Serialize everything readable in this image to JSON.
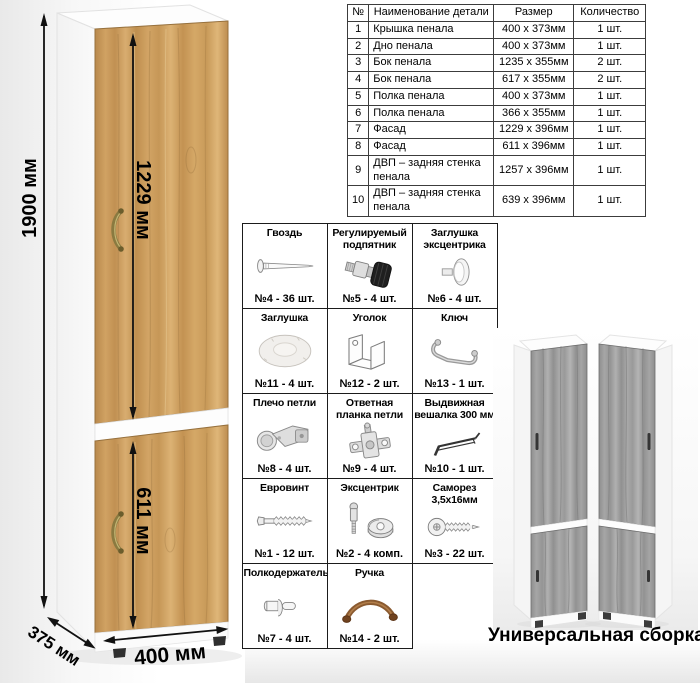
{
  "diagram": {
    "dimensions": {
      "height": "1900 мм",
      "upper_door": "1229 мм",
      "lower_door": "611 мм",
      "depth": "375 мм",
      "width": "400 мм"
    },
    "colors": {
      "wood": "#c89a5c",
      "wood_grain_dark": "#8f6a38",
      "gray_wood": "#9e9e9e",
      "carcass_white": "#fbfbfb",
      "handle_brass": "#8a7a40",
      "dimension_line": "#111111"
    }
  },
  "parts_table": {
    "headers": [
      "№",
      "Наименование детали",
      "Размер",
      "Количество"
    ],
    "rows": [
      {
        "num": "1",
        "name": "Крышка пенала",
        "size": "400 х 373мм",
        "qty": "1 шт."
      },
      {
        "num": "2",
        "name": "Дно пенала",
        "size": "400 х 373мм",
        "qty": "1 шт."
      },
      {
        "num": "3",
        "name": "Бок пенала",
        "size": "1235 х 355мм",
        "qty": "2 шт."
      },
      {
        "num": "4",
        "name": "Бок пенала",
        "size": "617 х 355мм",
        "qty": "2 шт."
      },
      {
        "num": "5",
        "name": "Полка пенала",
        "size": "400 х 373мм",
        "qty": "1 шт."
      },
      {
        "num": "6",
        "name": "Полка пенала",
        "size": "366 х 355мм",
        "qty": "1 шт."
      },
      {
        "num": "7",
        "name": "Фасад",
        "size": "1229 х 396мм",
        "qty": "1 шт."
      },
      {
        "num": "8",
        "name": "Фасад",
        "size": "611 х 396мм",
        "qty": "1 шт."
      },
      {
        "num": "9",
        "name": "ДВП – задняя стенка пенала",
        "size": "1257 х 396мм",
        "qty": "1 шт."
      },
      {
        "num": "10",
        "name": "ДВП – задняя стенка пенала",
        "size": "639 х 396мм",
        "qty": "1 шт."
      }
    ]
  },
  "hardware": {
    "items": [
      {
        "title": "Гвоздь",
        "qty": "№4 - 36 шт.",
        "icon": "nail-icon"
      },
      {
        "title": "Регулируемый подпятник",
        "qty": "№5 - 4 шт.",
        "icon": "adjustable-foot-icon"
      },
      {
        "title": "Заглушка эксцентрика",
        "qty": "№6 - 4 шт.",
        "icon": "cam-cover-icon"
      },
      {
        "title": "Заглушка",
        "qty": "№11 - 4 шт.",
        "icon": "cover-cap-icon"
      },
      {
        "title": "Уголок",
        "qty": "№12 - 2 шт.",
        "icon": "corner-bracket-icon"
      },
      {
        "title": "Ключ",
        "qty": "№13 - 1 шт.",
        "icon": "key-icon"
      },
      {
        "title": "Плечо петли",
        "qty": "№8 - 4 шт.",
        "icon": "hinge-arm-icon"
      },
      {
        "title": "Ответная планка петли",
        "qty": "№9 - 4 шт.",
        "icon": "hinge-plate-icon"
      },
      {
        "title": "Выдвижная вешалка 300 мм",
        "qty": "№10 - 1 шт.",
        "icon": "pullout-hanger-icon"
      },
      {
        "title": "Евровинт",
        "qty": "№1 - 12 шт.",
        "icon": "confirmat-screw-icon"
      },
      {
        "title": "Эксцентрик",
        "qty": "№2 - 4 комп.",
        "icon": "cam-lock-icon"
      },
      {
        "title": "Саморез 3,5х16мм",
        "qty": "№3 - 22 шт.",
        "icon": "self-tapping-screw-icon"
      },
      {
        "title": "Полкодержатель",
        "qty": "№7 - 4 шт.",
        "icon": "shelf-pin-icon"
      },
      {
        "title": "Ручка",
        "qty": "№14 - 2 шт.",
        "icon": "handle-icon"
      }
    ]
  },
  "footer": {
    "caption": "Универсальная сборка."
  }
}
